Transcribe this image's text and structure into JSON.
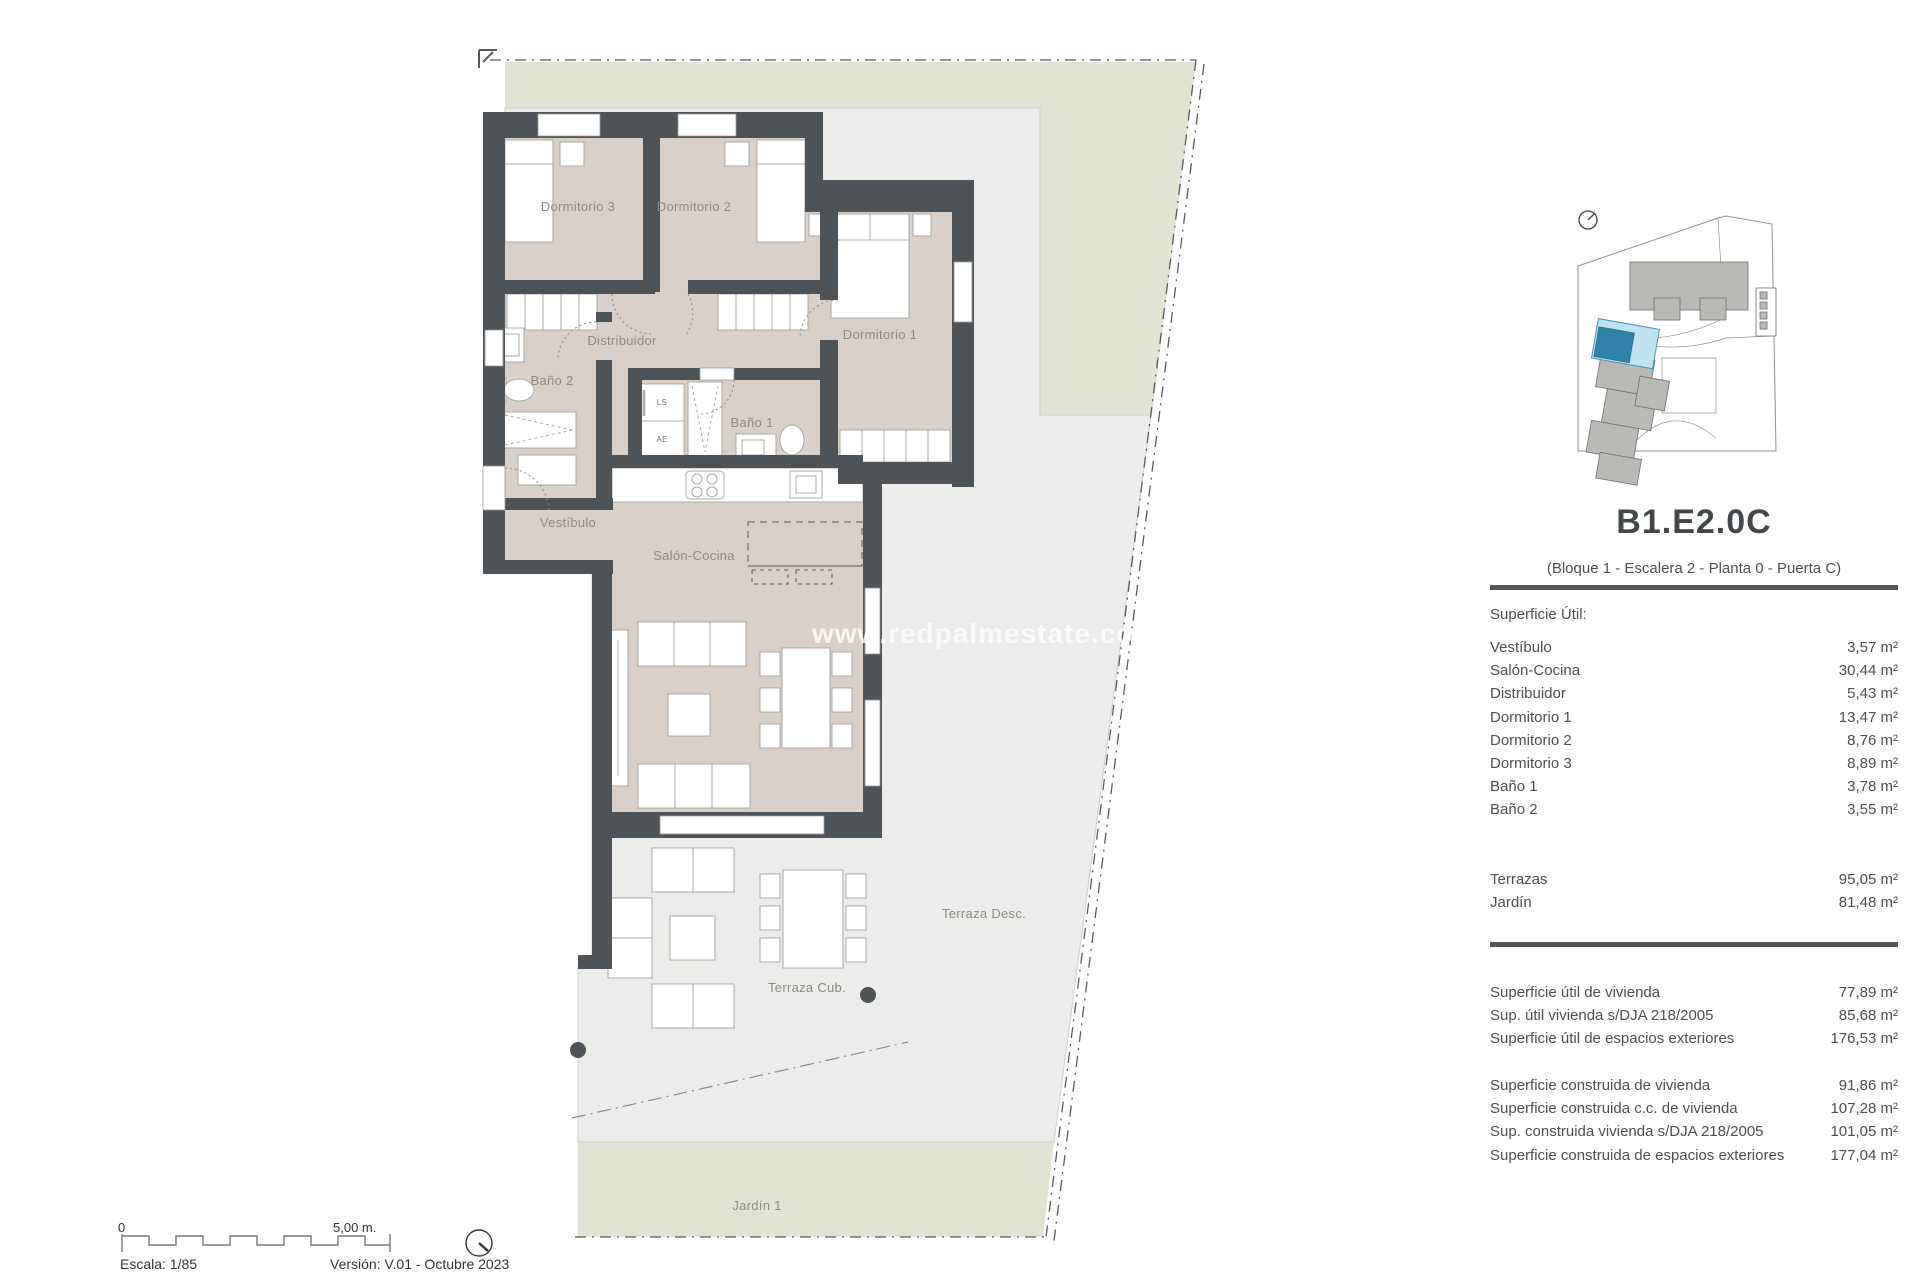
{
  "watermark": "www.redpalmestate.com",
  "plan": {
    "labels": {
      "dormitorio3": "Dormitorio 3",
      "dormitorio2": "Dormitorio 2",
      "dormitorio1": "Dormitorio 1",
      "distribuidor": "Distribuidor",
      "bano2": "Baño 2",
      "bano1": "Baño 1",
      "vestibulo": "Vestíbulo",
      "salon_cocina": "Salón-Cocina",
      "terraza_desc": "Terraza Desc.",
      "terraza_cub": "Terraza Cub.",
      "jardin1": "Jardín 1",
      "ls": "LS",
      "ae": "AE"
    },
    "colors": {
      "wall": "#4d5357",
      "floor": "#d9d0c9",
      "terrace": "#ececea",
      "garden": "#e0e4d2",
      "highlight_light_blue": "#bfe3f2",
      "highlight_blue": "#3181a8"
    }
  },
  "panel": {
    "title": "B1.E2.0C",
    "subtitle": "(Bloque 1 - Escalera 2 - Planta 0 - Puerta C)",
    "section_label": "Superficie Útil:",
    "rooms": [
      {
        "label": "Vestíbulo",
        "value": "3,57 m²"
      },
      {
        "label": "Salón-Cocina",
        "value": "30,44 m²"
      },
      {
        "label": "Distribuidor",
        "value": "5,43 m²"
      },
      {
        "label": "Dormitorio 1",
        "value": "13,47 m²"
      },
      {
        "label": "Dormitorio 2",
        "value": "8,76 m²"
      },
      {
        "label": "Dormitorio 3",
        "value": "8,89 m²"
      },
      {
        "label": "Baño 1",
        "value": "3,78 m²"
      },
      {
        "label": "Baño 2",
        "value": "3,55 m²"
      }
    ],
    "outdoor": [
      {
        "label": "Terrazas",
        "value": "95,05 m²"
      },
      {
        "label": "Jardín",
        "value": "81,48 m²"
      }
    ],
    "totals_util": [
      {
        "label": "Superficie útil de vivienda",
        "value": "77,89 m²"
      },
      {
        "label": "Sup. útil vivienda s/DJA 218/2005",
        "value": "85,68 m²"
      },
      {
        "label": "Superficie útil de espacios exteriores",
        "value": "176,53 m²"
      }
    ],
    "totals_construida": [
      {
        "label": "Superficie construida de vivienda",
        "value": "91,86 m²"
      },
      {
        "label": "Superficie construida c.c. de vivienda",
        "value": "107,28 m²"
      },
      {
        "label": "Sup. construida vivienda s/DJA 218/2005",
        "value": "101,05 m²"
      },
      {
        "label": "Superficie construida de espacios exteriores",
        "value": "177,04 m²"
      }
    ]
  },
  "footer": {
    "scale_zero": "0",
    "scale_end": "5,00 m.",
    "escala": "Escala: 1/85",
    "version": "Versión: V.01 - Octubre 2023"
  }
}
